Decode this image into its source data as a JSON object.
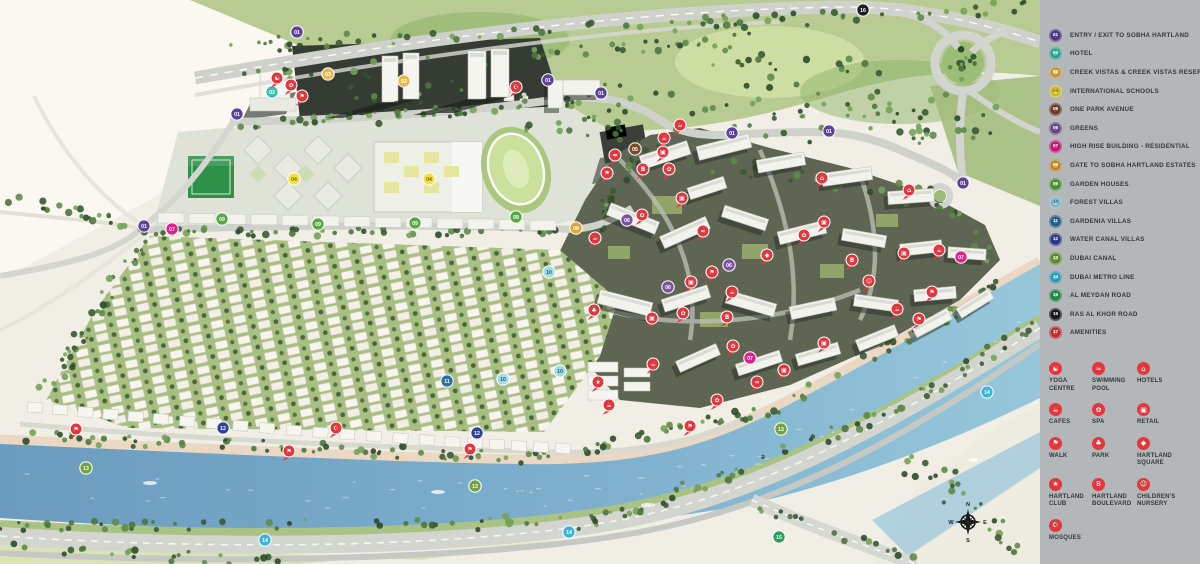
{
  "legend": {
    "items": [
      {
        "num": "01",
        "label": "ENTRY / EXIT TO SOBHA HARTLAND",
        "color": "#5b4397"
      },
      {
        "num": "02",
        "label": "HOTEL",
        "color": "#3fbdab"
      },
      {
        "num": "03",
        "label": "CREEK VISTAS & CREEK VISTAS RESERVÉ",
        "color": "#e5b94e"
      },
      {
        "num": "04",
        "label": "INTERNATIONAL SCHOOLS",
        "color": "#f2e23d",
        "text": "#77671a"
      },
      {
        "num": "05",
        "label": "ONE PARK AVENUE",
        "color": "#7b4a2d"
      },
      {
        "num": "06",
        "label": "GREENS",
        "color": "#7d52a0"
      },
      {
        "num": "07",
        "label": "HIGH RISE BUILDING - RESIDENTIAL",
        "color": "#e0218a"
      },
      {
        "num": "08",
        "label": "GATE TO SOBHA HARTLAND ESTATES",
        "color": "#e2a33c"
      },
      {
        "num": "09",
        "label": "GARDEN HOUSES",
        "color": "#58a743"
      },
      {
        "num": "10",
        "label": "FOREST VILLAS",
        "color": "#a6dbe8",
        "text": "#20606f"
      },
      {
        "num": "11",
        "label": "GARDENIA VILLAS",
        "color": "#2a6fa3"
      },
      {
        "num": "12",
        "label": "WATER CANAL VILLAS",
        "color": "#31409b"
      },
      {
        "num": "13",
        "label": "DUBAI CANAL",
        "color": "#71a33c"
      },
      {
        "num": "14",
        "label": "DUBAI METRO LINE",
        "color": "#3cb3d8"
      },
      {
        "num": "15",
        "label": "AL MEYDAN ROAD",
        "color": "#2b9e57"
      },
      {
        "num": "16",
        "label": "RAS AL KHOR ROAD",
        "color": "#1d1d1f"
      },
      {
        "num": "17",
        "label": "AMENITIES",
        "color": "#e2373d"
      }
    ],
    "amenities": [
      {
        "icon": "yoga",
        "label": "YOGA CENTRE"
      },
      {
        "icon": "pool",
        "label": "SWIMMING POOL"
      },
      {
        "icon": "hotel",
        "label": "HOTELS"
      },
      {
        "icon": "cafe",
        "label": "CAFES"
      },
      {
        "icon": "spa",
        "label": "SPA"
      },
      {
        "icon": "retail",
        "label": "RETAIL"
      },
      {
        "icon": "walk",
        "label": "WALK"
      },
      {
        "icon": "park",
        "label": "PARK"
      },
      {
        "icon": "square",
        "label": "HARTLAND SQUARE"
      },
      {
        "icon": "club",
        "label": "HARTLAND CLUB"
      },
      {
        "icon": "blvd",
        "label": "HARTLAND BOULEVARD"
      },
      {
        "icon": "nursery",
        "label": "CHILDREN'S NURSERY"
      },
      {
        "icon": "mosque",
        "label": "MOSQUES"
      }
    ]
  },
  "map": {
    "amenity_color": "#e2373d",
    "compass": {
      "n": "N",
      "e": "E",
      "s": "S",
      "w": "W"
    },
    "markers": [
      {
        "num": "01",
        "x": 297,
        "y": 32
      },
      {
        "num": "01",
        "x": 237,
        "y": 114
      },
      {
        "num": "01",
        "x": 144,
        "y": 226
      },
      {
        "num": "01",
        "x": 548,
        "y": 80
      },
      {
        "num": "01",
        "x": 601,
        "y": 93
      },
      {
        "num": "01",
        "x": 732,
        "y": 133
      },
      {
        "num": "01",
        "x": 829,
        "y": 131
      },
      {
        "num": "01",
        "x": 963,
        "y": 183
      },
      {
        "num": "02",
        "x": 272,
        "y": 92
      },
      {
        "num": "03",
        "x": 328,
        "y": 74
      },
      {
        "num": "03",
        "x": 404,
        "y": 81
      },
      {
        "num": "04",
        "x": 294,
        "y": 179
      },
      {
        "num": "04",
        "x": 429,
        "y": 179
      },
      {
        "num": "05",
        "x": 635,
        "y": 149
      },
      {
        "num": "06",
        "x": 627,
        "y": 220
      },
      {
        "num": "06",
        "x": 668,
        "y": 287
      },
      {
        "num": "06",
        "x": 729,
        "y": 265
      },
      {
        "num": "07",
        "x": 172,
        "y": 229
      },
      {
        "num": "07",
        "x": 750,
        "y": 358
      },
      {
        "num": "07",
        "x": 961,
        "y": 257
      },
      {
        "num": "08",
        "x": 576,
        "y": 228
      },
      {
        "num": "09",
        "x": 222,
        "y": 219
      },
      {
        "num": "09",
        "x": 318,
        "y": 224
      },
      {
        "num": "09",
        "x": 415,
        "y": 223
      },
      {
        "num": "09",
        "x": 516,
        "y": 217
      },
      {
        "num": "10",
        "x": 549,
        "y": 272
      },
      {
        "num": "10",
        "x": 560,
        "y": 371
      },
      {
        "num": "10",
        "x": 503,
        "y": 379
      },
      {
        "num": "11",
        "x": 447,
        "y": 381
      },
      {
        "num": "12",
        "x": 223,
        "y": 428
      },
      {
        "num": "12",
        "x": 477,
        "y": 433
      },
      {
        "num": "13",
        "x": 86,
        "y": 468
      },
      {
        "num": "13",
        "x": 475,
        "y": 486
      },
      {
        "num": "13",
        "x": 781,
        "y": 429
      },
      {
        "num": "14",
        "x": 265,
        "y": 540
      },
      {
        "num": "14",
        "x": 569,
        "y": 532
      },
      {
        "num": "14",
        "x": 987,
        "y": 392
      },
      {
        "num": "15",
        "x": 779,
        "y": 537
      },
      {
        "num": "16",
        "x": 863,
        "y": 10
      }
    ],
    "amenity_markers": [
      {
        "icon": "yoga",
        "x": 277,
        "y": 78
      },
      {
        "icon": "spa",
        "x": 291,
        "y": 85
      },
      {
        "icon": "walk",
        "x": 302,
        "y": 96
      },
      {
        "icon": "mosque",
        "x": 516,
        "y": 87
      },
      {
        "icon": "cafe",
        "x": 664,
        "y": 138
      },
      {
        "icon": "cafe",
        "x": 680,
        "y": 125
      },
      {
        "icon": "retail",
        "x": 663,
        "y": 152
      },
      {
        "icon": "pool",
        "x": 615,
        "y": 155
      },
      {
        "icon": "walk",
        "x": 607,
        "y": 173
      },
      {
        "icon": "spa",
        "x": 669,
        "y": 169
      },
      {
        "icon": "retail",
        "x": 682,
        "y": 198
      },
      {
        "icon": "spa",
        "x": 642,
        "y": 215
      },
      {
        "icon": "pool",
        "x": 703,
        "y": 231
      },
      {
        "icon": "hotel",
        "x": 822,
        "y": 178
      },
      {
        "icon": "retail",
        "x": 824,
        "y": 222
      },
      {
        "icon": "spa",
        "x": 804,
        "y": 235
      },
      {
        "icon": "hotel",
        "x": 909,
        "y": 190
      },
      {
        "icon": "cafe",
        "x": 939,
        "y": 250
      },
      {
        "icon": "retail",
        "x": 904,
        "y": 253
      },
      {
        "icon": "walk",
        "x": 712,
        "y": 272
      },
      {
        "icon": "retail",
        "x": 691,
        "y": 282
      },
      {
        "icon": "cafe",
        "x": 732,
        "y": 292
      },
      {
        "icon": "retail",
        "x": 652,
        "y": 318
      },
      {
        "icon": "spa",
        "x": 683,
        "y": 313
      },
      {
        "icon": "park",
        "x": 594,
        "y": 310
      },
      {
        "icon": "walk",
        "x": 932,
        "y": 292
      },
      {
        "icon": "cafe",
        "x": 897,
        "y": 309
      },
      {
        "icon": "walk",
        "x": 919,
        "y": 319
      },
      {
        "icon": "blvd",
        "x": 643,
        "y": 169
      },
      {
        "icon": "blvd",
        "x": 852,
        "y": 260
      },
      {
        "icon": "blvd",
        "x": 727,
        "y": 317
      },
      {
        "icon": "walk",
        "x": 76,
        "y": 429
      },
      {
        "icon": "walk",
        "x": 289,
        "y": 451
      },
      {
        "icon": "walk",
        "x": 470,
        "y": 449
      },
      {
        "icon": "mosque",
        "x": 336,
        "y": 428
      },
      {
        "icon": "club",
        "x": 598,
        "y": 382
      },
      {
        "icon": "spa",
        "x": 733,
        "y": 346
      },
      {
        "icon": "retail",
        "x": 824,
        "y": 343
      },
      {
        "icon": "cafe",
        "x": 653,
        "y": 364
      },
      {
        "icon": "retail",
        "x": 784,
        "y": 370
      },
      {
        "icon": "pool",
        "x": 757,
        "y": 382
      },
      {
        "icon": "spa",
        "x": 717,
        "y": 400
      },
      {
        "icon": "cafe",
        "x": 609,
        "y": 405
      },
      {
        "icon": "walk",
        "x": 690,
        "y": 426
      },
      {
        "icon": "nursery",
        "x": 869,
        "y": 281
      },
      {
        "icon": "square",
        "x": 767,
        "y": 255
      },
      {
        "icon": "cafe",
        "x": 595,
        "y": 238
      }
    ]
  }
}
